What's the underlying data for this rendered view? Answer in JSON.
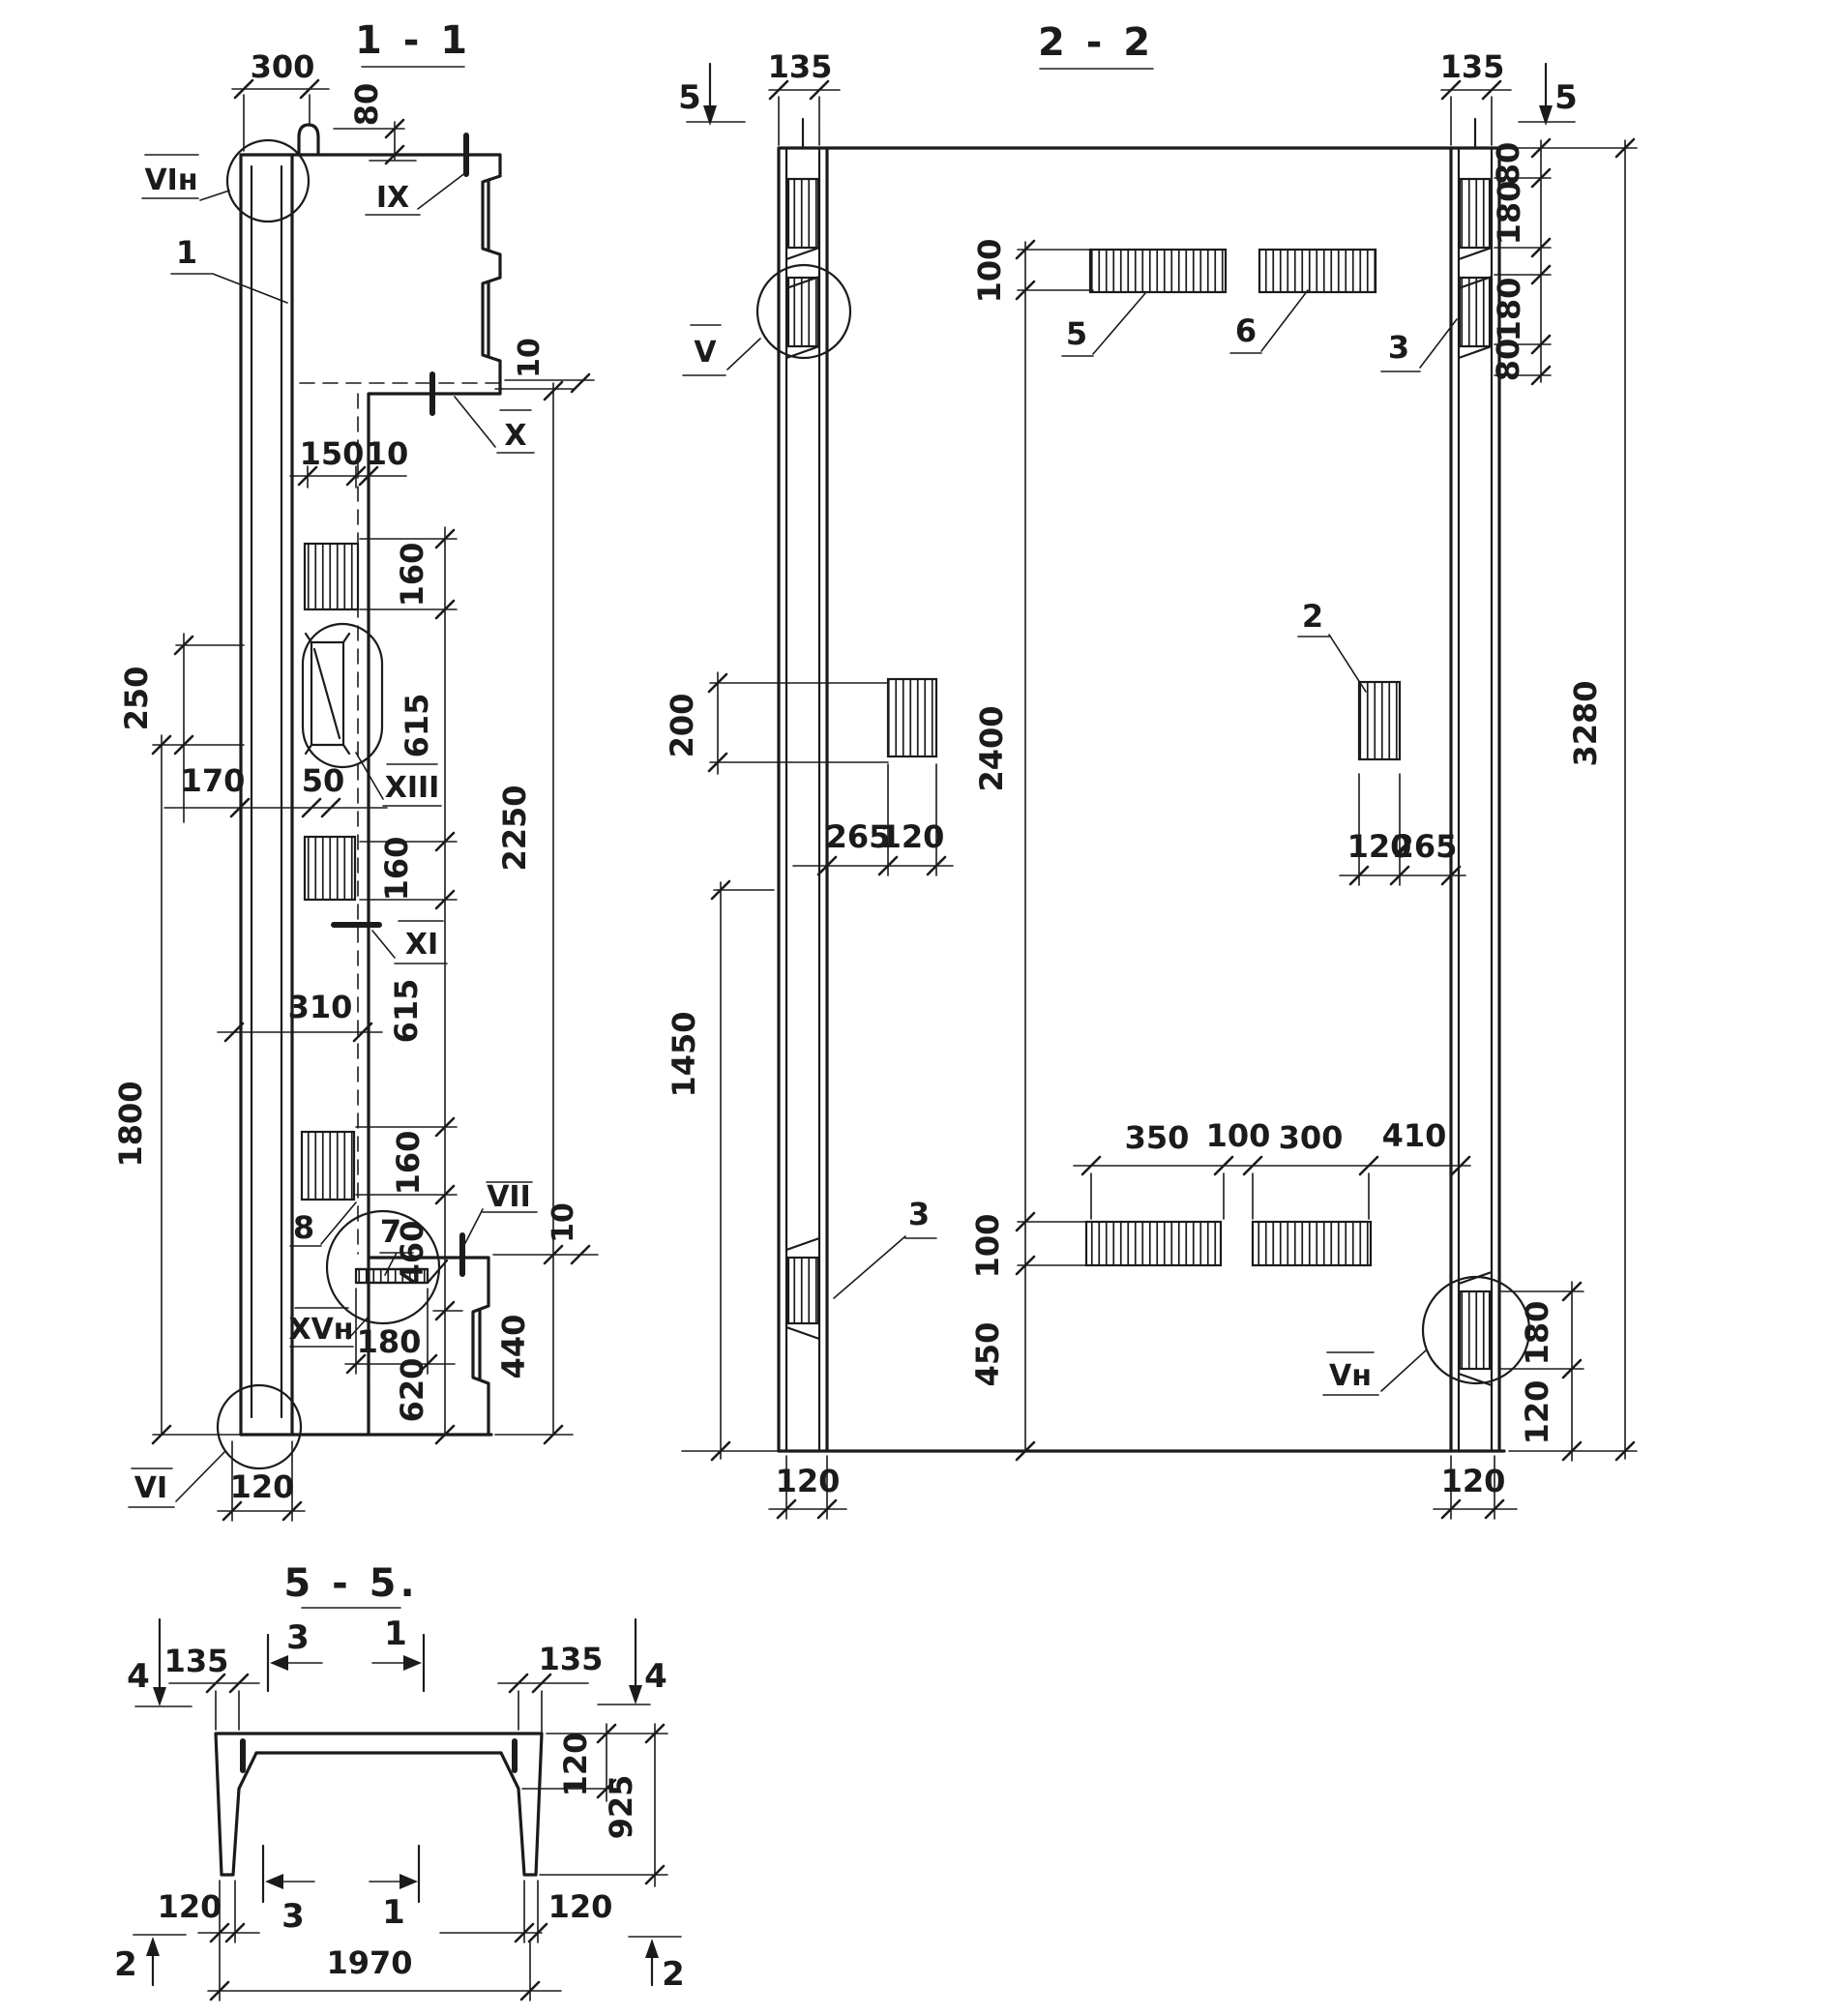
{
  "s11": {
    "title": "1 - 1",
    "d300": "300",
    "d80": "80",
    "d150": "150",
    "d10t": "10",
    "d160a": "160",
    "d615a": "615",
    "d160b": "160",
    "d615b": "615",
    "d160c": "160",
    "d460": "460",
    "d620": "620",
    "d250": "250",
    "d170": "170",
    "d50": "50",
    "d310": "310",
    "d1800": "1800",
    "d2250": "2250",
    "d440": "440",
    "d10m": "10",
    "d180": "180",
    "d120": "120",
    "lVIn": "VIн",
    "l1": "1",
    "lIX": "IX",
    "lX": "X",
    "lXIII": "XIII",
    "lXI": "XI",
    "l8": "8",
    "l7": "7",
    "lXVn": "XVн",
    "lVII": "VII",
    "lVI": "VI"
  },
  "s22": {
    "title": "2 - 2",
    "m5l": "5",
    "m5r": "5",
    "d135l": "135",
    "d135r": "135",
    "d100t": "100",
    "d80a": "80",
    "d180a": "180",
    "d180b": "180",
    "d80b": "80",
    "d3280": "3280",
    "d200": "200",
    "d2400": "2400",
    "d265l": "265",
    "d120l": "120",
    "d120r": "120",
    "d265r": "265",
    "d1450": "1450",
    "d100b": "100",
    "d450": "450",
    "d350": "350",
    "d100c": "100",
    "d300": "300",
    "d410": "410",
    "d180br": "180",
    "d120br": "120",
    "d120colL": "120",
    "d120colR": "120",
    "lV": "V",
    "l5": "5",
    "l6": "6",
    "l3r": "3",
    "l2": "2",
    "l3l": "3",
    "lVn": "Vн"
  },
  "s55": {
    "title": "5 - 5.",
    "m4l": "4",
    "m4r": "4",
    "m3t": "3",
    "m1t": "1",
    "m3b": "3",
    "m1b": "1",
    "m2l": "2",
    "m2r": "2",
    "d135l": "135",
    "d135r": "135",
    "d120r": "120",
    "d925": "925",
    "d120bl": "120",
    "d120br": "120",
    "d1970": "1970"
  }
}
